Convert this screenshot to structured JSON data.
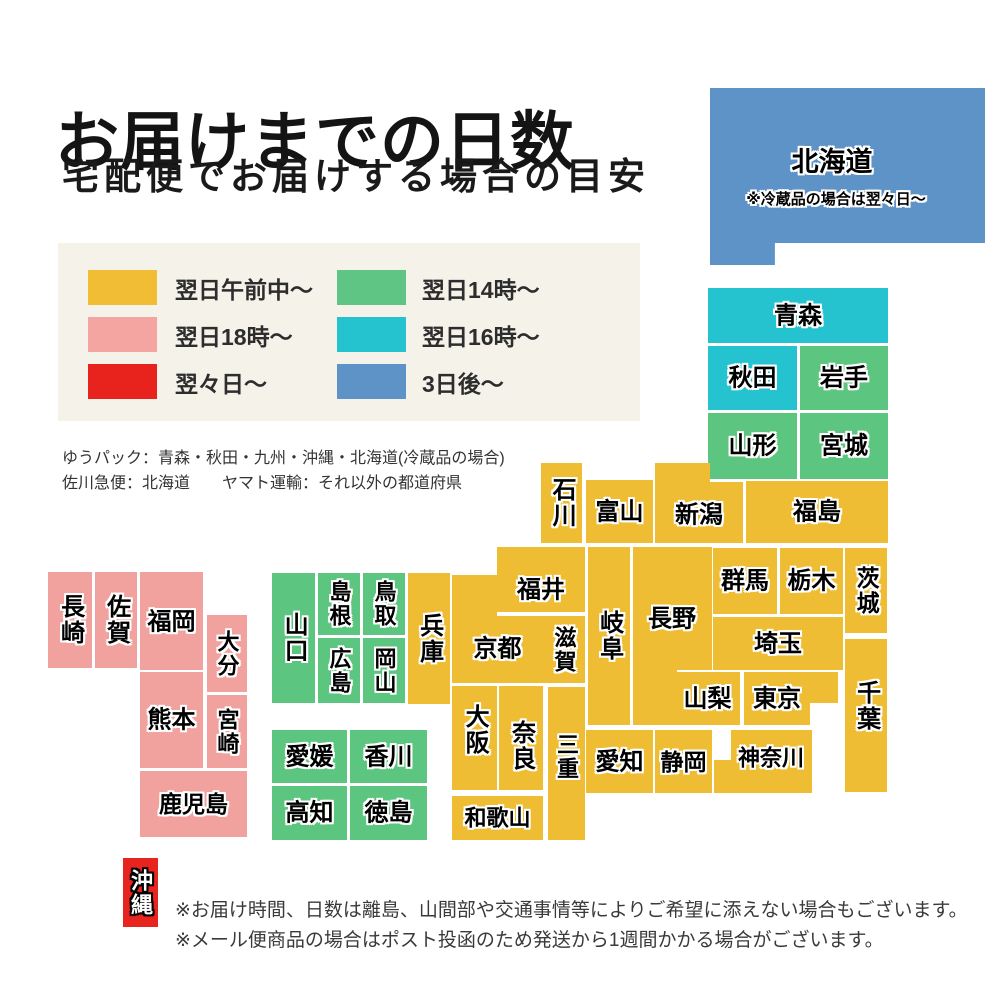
{
  "title": "お届けまでの日数",
  "subtitle": "宅配便でお届けする場合の目安",
  "legend": {
    "background": "#f5f2ea",
    "items": [
      {
        "id": "next-morning",
        "label": "翌日午前中〜",
        "color": "#f0bd34"
      },
      {
        "id": "next-18",
        "label": "翌日18時〜",
        "color": "#f4a4a1"
      },
      {
        "id": "two-days",
        "label": "翌々日〜",
        "color": "#e8231e"
      },
      {
        "id": "next-14",
        "label": "翌日14時〜",
        "color": "#5fc584"
      },
      {
        "id": "next-16",
        "label": "翌日16時〜",
        "color": "#25c3d0"
      },
      {
        "id": "three-days",
        "label": "3日後〜",
        "color": "#5e93c8"
      }
    ]
  },
  "carriers": {
    "line1": "ゆうパック：青森・秋田・九州・沖縄・北海道(冷蔵品の場合)",
    "line2": "佐川急便：北海道　　ヤマト運輸：それ以外の都道府県"
  },
  "notes": {
    "line1": "※お届け時間、日数は離島、山間部や交通事情等によりご希望に添えない場合もございます。",
    "line2": "※メール便商品の場合はポスト投函のため発送から1週間かかる場合がございます。"
  },
  "map": {
    "colors": {
      "y": "#efbd33",
      "g": "#5cc57f",
      "t": "#25c3d0",
      "p": "#f1a19e",
      "b": "#5e93c8",
      "r": "#e7241f"
    },
    "prefectures": [
      {
        "id": "hokkaido",
        "name": "北海道",
        "c": "b",
        "x": 710,
        "y": 88,
        "w": 275,
        "h": 177,
        "fs": 27,
        "lx": 122,
        "ly": 74,
        "clip": "polygon(0 0, 100% 0, 100% 87.6%, 23.6% 87.6%, 23.6% 100%, 0 100%)",
        "note": "※冷蔵品の場合は翌々日〜",
        "nx": 126,
        "ny": 112
      },
      {
        "id": "aomori",
        "name": "青森",
        "c": "t",
        "x": 708,
        "y": 288,
        "w": 180,
        "h": 55
      },
      {
        "id": "akita",
        "name": "秋田",
        "c": "t",
        "x": 708,
        "y": 346,
        "w": 89,
        "h": 64
      },
      {
        "id": "iwate",
        "name": "岩手",
        "c": "g",
        "x": 800,
        "y": 346,
        "w": 88,
        "h": 64
      },
      {
        "id": "yamagata",
        "name": "山形",
        "c": "g",
        "x": 708,
        "y": 413,
        "w": 89,
        "h": 66
      },
      {
        "id": "miyagi",
        "name": "宮城",
        "c": "g",
        "x": 800,
        "y": 413,
        "w": 88,
        "h": 66
      },
      {
        "id": "fukushima",
        "name": "福島",
        "c": "y",
        "x": 746,
        "y": 481,
        "w": 142,
        "h": 62
      },
      {
        "id": "niigata",
        "name": "新潟",
        "c": "y",
        "x": 655,
        "y": 463,
        "w": 88,
        "h": 80,
        "ly": 52,
        "clip": "polygon(0 0, 62.5% 0, 62.5% 23.8%, 100% 23.8%, 100% 100%, 0 100%)"
      },
      {
        "id": "ishikawa",
        "name": "石川",
        "c": "y",
        "x": 541,
        "y": 463,
        "w": 41,
        "h": 80,
        "v": true
      },
      {
        "id": "toyama",
        "name": "富山",
        "c": "y",
        "x": 586,
        "y": 480,
        "w": 67,
        "h": 63
      },
      {
        "id": "fukui",
        "name": "福井",
        "c": "y",
        "x": 497,
        "y": 547,
        "w": 88,
        "h": 65,
        "ly": 43
      },
      {
        "id": "gifu",
        "name": "岐阜",
        "c": "y",
        "x": 588,
        "y": 547,
        "w": 42,
        "h": 178,
        "v": true
      },
      {
        "id": "nagano",
        "name": "長野",
        "c": "y",
        "x": 633,
        "y": 547,
        "w": 79,
        "h": 178,
        "lx": 39,
        "ly": 72,
        "clip": "polygon(0 0, 100% 0, 100% 69.1%, 55.7% 69.1%, 55.7% 100%, 0 100%)"
      },
      {
        "id": "gunma",
        "name": "群馬",
        "c": "y",
        "x": 713,
        "y": 548,
        "w": 64,
        "h": 66
      },
      {
        "id": "tochigi",
        "name": "栃木",
        "c": "y",
        "x": 780,
        "y": 548,
        "w": 63,
        "h": 66
      },
      {
        "id": "ibaraki",
        "name": "茨城",
        "c": "y",
        "x": 845,
        "y": 548,
        "w": 42,
        "h": 85,
        "v": true,
        "fs": 23
      },
      {
        "id": "saitama",
        "name": "埼玉",
        "c": "y",
        "x": 713,
        "y": 617,
        "w": 130,
        "h": 53
      },
      {
        "id": "yamanashi",
        "name": "山梨",
        "c": "y",
        "x": 675,
        "y": 672,
        "w": 65,
        "h": 53
      },
      {
        "id": "tokyo",
        "name": "東京",
        "c": "y",
        "x": 744,
        "y": 672,
        "w": 94,
        "h": 53,
        "lx": 33,
        "clip": "polygon(0 0, 100% 0, 100% 58.5%, 70.2% 58.5%, 70.2% 100%, 0 100%)"
      },
      {
        "id": "chiba",
        "name": "千葉",
        "c": "y",
        "x": 845,
        "y": 639,
        "w": 42,
        "h": 153,
        "v": true,
        "ly": 67
      },
      {
        "id": "kanagawa",
        "name": "神奈川",
        "c": "y",
        "x": 714,
        "y": 730,
        "w": 98,
        "h": 63,
        "fs": 22,
        "lx": 57,
        "ly": 28,
        "clip": "polygon(17.3% 0, 100% 0, 100% 100%, 0 100%, 0 47.6%, 17.3% 47.6%)"
      },
      {
        "id": "shizuoka",
        "name": "静岡",
        "c": "y",
        "x": 655,
        "y": 730,
        "w": 57,
        "h": 63,
        "fs": 23
      },
      {
        "id": "aichi",
        "name": "愛知",
        "c": "y",
        "x": 586,
        "y": 730,
        "w": 67,
        "h": 63
      },
      {
        "id": "mie",
        "name": "三重",
        "c": "y",
        "x": 548,
        "y": 687,
        "w": 37,
        "h": 153,
        "v": true,
        "fs": 22,
        "ly": 70
      },
      {
        "id": "shiga",
        "name": "滋賀",
        "c": "y",
        "x": 543,
        "y": 616,
        "w": 42,
        "h": 67,
        "v": true,
        "fs": 22
      },
      {
        "id": "kyoto",
        "name": "京都",
        "c": "y",
        "x": 452,
        "y": 575,
        "w": 91,
        "h": 108,
        "ly": 74,
        "clip": "polygon(0 0, 49.5% 0, 49.5% 38%, 100% 38%, 100% 100%, 0 100%)"
      },
      {
        "id": "osaka",
        "name": "大阪",
        "c": "y",
        "x": 452,
        "y": 686,
        "w": 45,
        "h": 104,
        "v": true,
        "ly": 44
      },
      {
        "id": "nara",
        "name": "奈良",
        "c": "y",
        "x": 499,
        "y": 686,
        "w": 44,
        "h": 104,
        "v": true,
        "ly": 60
      },
      {
        "id": "wakayama",
        "name": "和歌山",
        "c": "y",
        "x": 452,
        "y": 796,
        "w": 91,
        "h": 44,
        "fs": 22
      },
      {
        "id": "hyogo",
        "name": "兵庫",
        "c": "y",
        "x": 408,
        "y": 573,
        "w": 42,
        "h": 131,
        "v": true
      },
      {
        "id": "yamaguchi",
        "name": "山口",
        "c": "g",
        "x": 272,
        "y": 573,
        "w": 43,
        "h": 130,
        "v": true
      },
      {
        "id": "shimane",
        "name": "島根",
        "c": "g",
        "x": 318,
        "y": 573,
        "w": 42,
        "h": 62,
        "v": true,
        "fs": 22
      },
      {
        "id": "tottori",
        "name": "鳥取",
        "c": "g",
        "x": 363,
        "y": 573,
        "w": 42,
        "h": 62,
        "v": true,
        "fs": 22
      },
      {
        "id": "hiroshima",
        "name": "広島",
        "c": "g",
        "x": 318,
        "y": 638,
        "w": 42,
        "h": 65,
        "v": true,
        "fs": 22
      },
      {
        "id": "okayama",
        "name": "岡山",
        "c": "g",
        "x": 363,
        "y": 638,
        "w": 42,
        "h": 65,
        "v": true,
        "fs": 22
      },
      {
        "id": "ehime",
        "name": "愛媛",
        "c": "g",
        "x": 272,
        "y": 730,
        "w": 75,
        "h": 53
      },
      {
        "id": "kagawa",
        "name": "香川",
        "c": "g",
        "x": 350,
        "y": 730,
        "w": 77,
        "h": 53
      },
      {
        "id": "kochi",
        "name": "高知",
        "c": "g",
        "x": 272,
        "y": 786,
        "w": 75,
        "h": 54
      },
      {
        "id": "tokushima",
        "name": "徳島",
        "c": "g",
        "x": 350,
        "y": 786,
        "w": 77,
        "h": 54
      },
      {
        "id": "nagasaki",
        "name": "長崎",
        "c": "p",
        "x": 48,
        "y": 572,
        "w": 44,
        "h": 96,
        "v": true
      },
      {
        "id": "saga",
        "name": "佐賀",
        "c": "p",
        "x": 95,
        "y": 572,
        "w": 42,
        "h": 96,
        "v": true
      },
      {
        "id": "fukuoka",
        "name": "福岡",
        "c": "p",
        "x": 140,
        "y": 572,
        "w": 63,
        "h": 98,
        "ly": 50
      },
      {
        "id": "oita",
        "name": "大分",
        "c": "p",
        "x": 207,
        "y": 615,
        "w": 40,
        "h": 77,
        "v": true,
        "fs": 22
      },
      {
        "id": "kumamoto",
        "name": "熊本",
        "c": "p",
        "x": 140,
        "y": 672,
        "w": 63,
        "h": 96
      },
      {
        "id": "miyazaki",
        "name": "宮崎",
        "c": "p",
        "x": 207,
        "y": 695,
        "w": 40,
        "h": 73,
        "v": true,
        "fs": 22
      },
      {
        "id": "kagoshima",
        "name": "鹿児島",
        "c": "p",
        "x": 140,
        "y": 771,
        "w": 107,
        "h": 66,
        "fs": 23
      },
      {
        "id": "okinawa",
        "name": "沖縄",
        "c": "r",
        "x": 123,
        "y": 858,
        "w": 35,
        "h": 69,
        "v": true,
        "fs": 22,
        "white": true
      }
    ]
  }
}
